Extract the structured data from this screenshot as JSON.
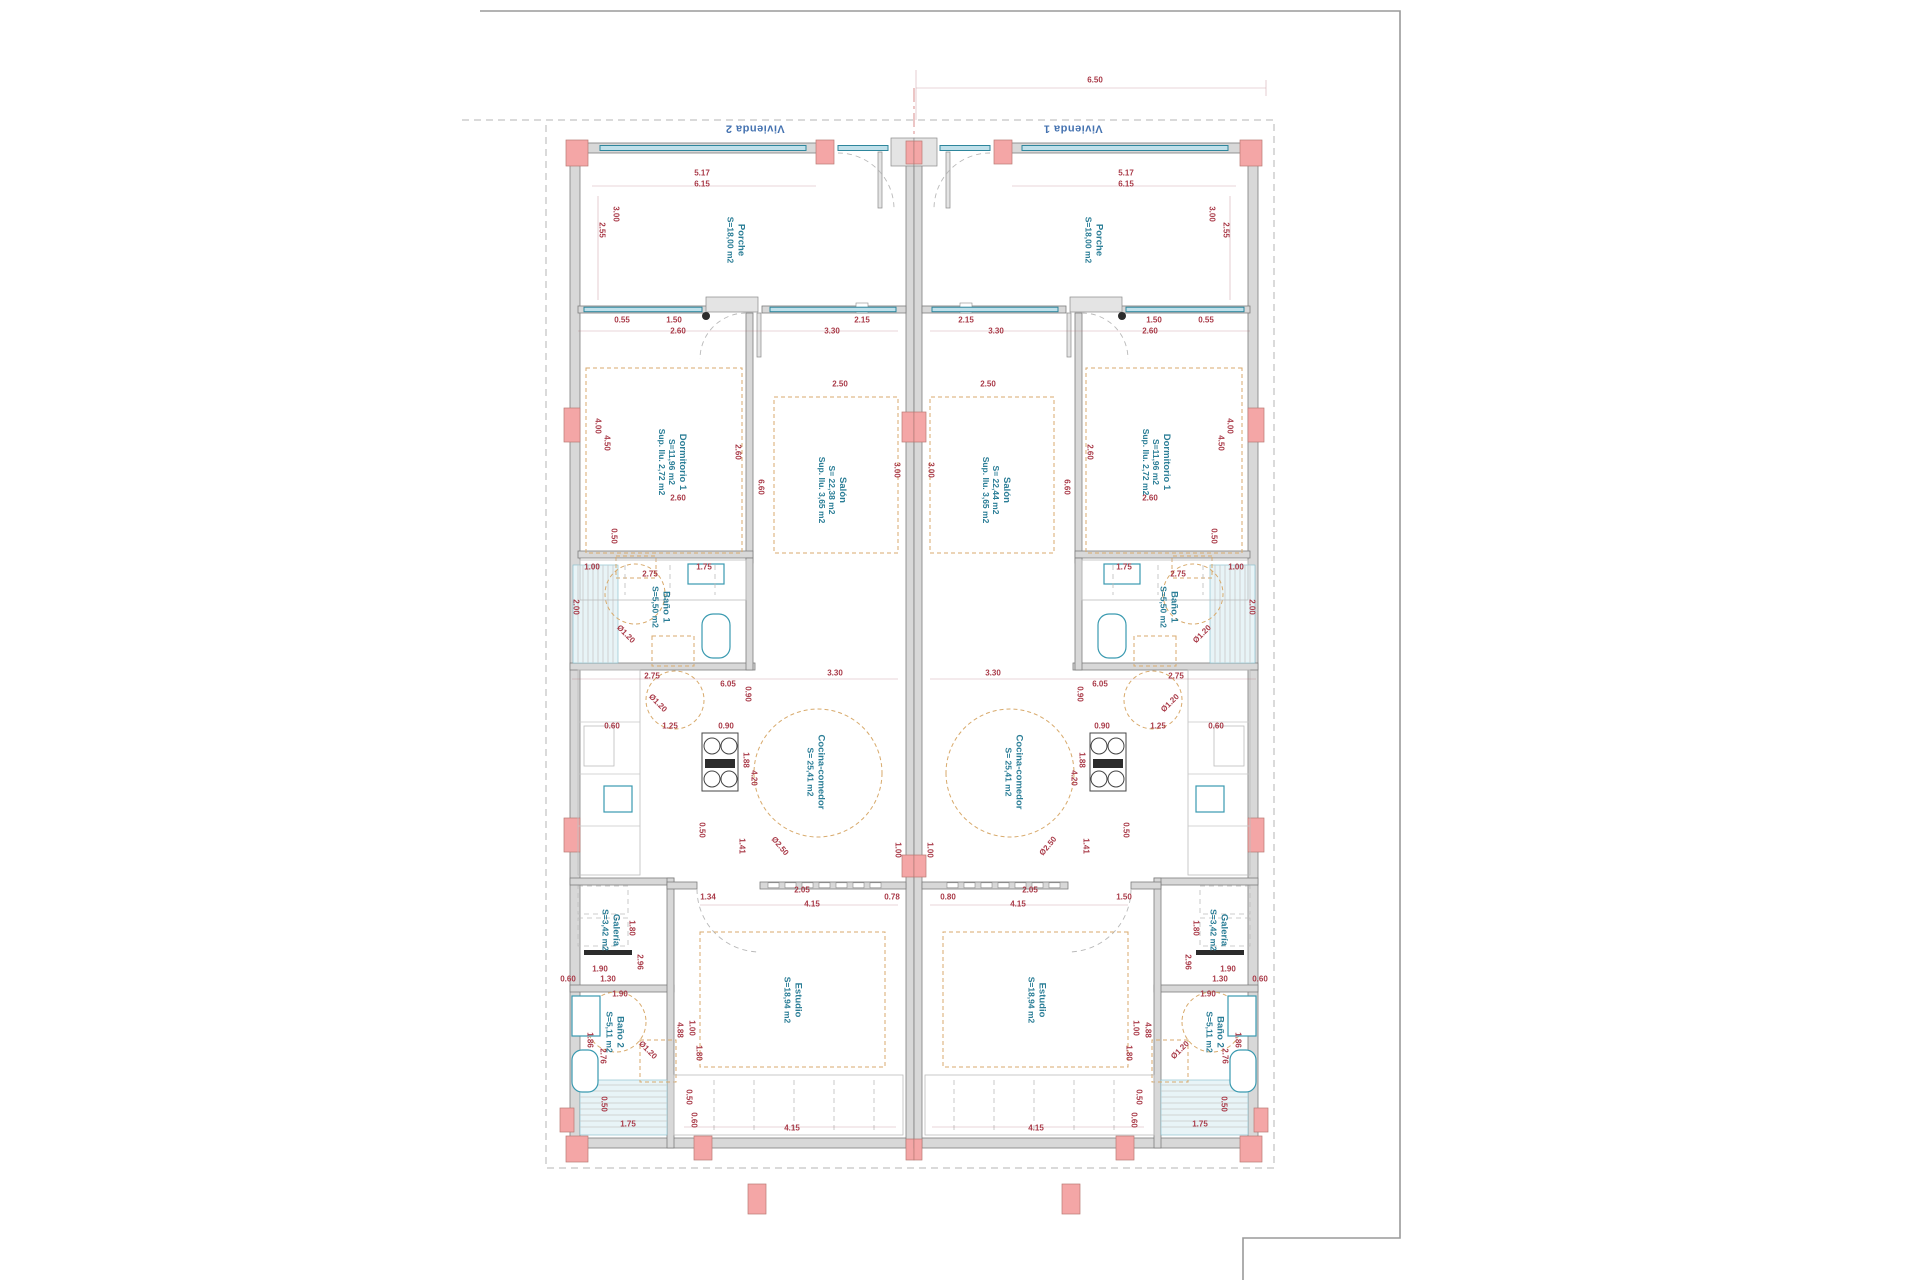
{
  "drawing": {
    "type": "architectural-floor-plan",
    "dwellings": [
      {
        "name": "Vivienda 2",
        "side": "left"
      },
      {
        "name": "Vivienda 1",
        "side": "right"
      }
    ],
    "colors": {
      "wall_fill": "#d8d8d8",
      "column_pink": "#f4a6a6",
      "window_teal": "#2e869c",
      "dimension_red": "#a93a48",
      "room_label_teal": "#2a7d96",
      "vivienda_blue": "#4472b0",
      "furniture_tan": "#d8aa6c"
    },
    "mirror_x": 914,
    "room_labels": [
      {
        "lines": [
          "Vivienda 2"
        ],
        "x": 755,
        "y": 128,
        "r": 180,
        "cls": "viv"
      },
      {
        "lines": [
          "Vivienda 1"
        ],
        "x": 1073,
        "y": 128,
        "r": 180,
        "cls": "viv"
      },
      {
        "lines": [
          "Porche",
          "S=18,00 m2"
        ],
        "x": 735,
        "y": 240,
        "r": 90,
        "cls": "room"
      },
      {
        "lines": [
          "Porche",
          "S=18,00 m2"
        ],
        "x": 1093,
        "y": 240,
        "r": 90,
        "cls": "room"
      },
      {
        "lines": [
          "Dormitorio 1",
          "S=11,96 m2",
          "Sup. Ilu. 2,72 m2"
        ],
        "x": 672,
        "y": 462,
        "r": 90,
        "cls": "room"
      },
      {
        "lines": [
          "Dormitorio 1",
          "S=11,96 m2",
          "Sup. Ilu. 2,72 m2"
        ],
        "x": 1156,
        "y": 462,
        "r": 90,
        "cls": "room"
      },
      {
        "lines": [
          "Salón",
          "S= 22,38 m2",
          "Sup. Ilu. 3,65 m2"
        ],
        "x": 832,
        "y": 490,
        "r": 90,
        "cls": "room"
      },
      {
        "lines": [
          "Salón",
          "S= 22,44 m2",
          "Sup. Ilu. 3,65 m2"
        ],
        "x": 996,
        "y": 490,
        "r": 90,
        "cls": "room"
      },
      {
        "lines": [
          "Baño 1",
          "S=5,50 m2"
        ],
        "x": 660,
        "y": 607,
        "r": 90,
        "cls": "room"
      },
      {
        "lines": [
          "Baño 1",
          "S=5,50 m2"
        ],
        "x": 1168,
        "y": 607,
        "r": 90,
        "cls": "room"
      },
      {
        "lines": [
          "Cocina-comedor",
          "S= 25,41 m2"
        ],
        "x": 815,
        "y": 772,
        "r": 90,
        "cls": "room"
      },
      {
        "lines": [
          "Cocina-comedor",
          "S= 25,41 m2"
        ],
        "x": 1013,
        "y": 772,
        "r": 90,
        "cls": "room"
      },
      {
        "lines": [
          "Galería",
          "S=3,42 m2"
        ],
        "x": 610,
        "y": 930,
        "r": 90,
        "cls": "room"
      },
      {
        "lines": [
          "Galería",
          "S=3,42 m2"
        ],
        "x": 1218,
        "y": 930,
        "r": 90,
        "cls": "room"
      },
      {
        "lines": [
          "Estudio",
          "S=18,94 m2"
        ],
        "x": 792,
        "y": 1000,
        "r": 90,
        "cls": "room"
      },
      {
        "lines": [
          "Estudio",
          "S=18,94 m2"
        ],
        "x": 1036,
        "y": 1000,
        "r": 90,
        "cls": "room"
      },
      {
        "lines": [
          "Baño 2",
          "S=5,11 m2"
        ],
        "x": 614,
        "y": 1032,
        "r": 90,
        "cls": "room"
      },
      {
        "lines": [
          "Baño 2",
          "S=5,11 m2"
        ],
        "x": 1214,
        "y": 1032,
        "r": 90,
        "cls": "room"
      }
    ],
    "dimensions": [
      {
        "t": "6.50",
        "x": 1095,
        "y": 80
      },
      {
        "t": "5.17",
        "x": 702,
        "y": 173,
        "m": 1
      },
      {
        "t": "6.15",
        "x": 702,
        "y": 184,
        "m": 1
      },
      {
        "t": "3.00",
        "x": 616,
        "y": 214,
        "r": 90,
        "m": 1
      },
      {
        "t": "2.55",
        "x": 602,
        "y": 230,
        "r": 90,
        "m": 1
      },
      {
        "t": "0.55",
        "x": 622,
        "y": 320,
        "m": 1
      },
      {
        "t": "1.50",
        "x": 674,
        "y": 320,
        "m": 1
      },
      {
        "t": "2.60",
        "x": 678,
        "y": 331,
        "m": 1
      },
      {
        "t": "2.15",
        "x": 862,
        "y": 320,
        "m": 1
      },
      {
        "t": "3.30",
        "x": 832,
        "y": 331,
        "m": 1
      },
      {
        "t": "4.00",
        "x": 598,
        "y": 426,
        "r": 90,
        "m": 1
      },
      {
        "t": "4.50",
        "x": 607,
        "y": 443,
        "r": 90,
        "m": 1
      },
      {
        "t": "2.60",
        "x": 738,
        "y": 452,
        "r": 90,
        "m": 1
      },
      {
        "t": "2.60",
        "x": 678,
        "y": 498,
        "m": 1
      },
      {
        "t": "0.50",
        "x": 614,
        "y": 536,
        "r": 90,
        "m": 1
      },
      {
        "t": "2.50",
        "x": 840,
        "y": 384,
        "m": 1
      },
      {
        "t": "3.00",
        "x": 897,
        "y": 470,
        "r": 90,
        "m": 1
      },
      {
        "t": "6.60",
        "x": 761,
        "y": 487,
        "r": 90,
        "m": 1
      },
      {
        "t": "1.00",
        "x": 592,
        "y": 567,
        "m": 1
      },
      {
        "t": "2.75",
        "x": 650,
        "y": 574,
        "m": 1
      },
      {
        "t": "1.75",
        "x": 704,
        "y": 567,
        "m": 1
      },
      {
        "t": "2.00",
        "x": 576,
        "y": 607,
        "r": 90,
        "m": 1
      },
      {
        "t": "Ø1.20",
        "x": 626,
        "y": 634,
        "r": 45,
        "m": 1
      },
      {
        "t": "2.75",
        "x": 652,
        "y": 676,
        "m": 1
      },
      {
        "t": "6.05",
        "x": 728,
        "y": 684,
        "m": 1
      },
      {
        "t": "3.30",
        "x": 835,
        "y": 673,
        "m": 1
      },
      {
        "t": "0.90",
        "x": 748,
        "y": 694,
        "r": 90,
        "m": 1
      },
      {
        "t": "Ø1.20",
        "x": 658,
        "y": 703,
        "r": 45,
        "m": 1
      },
      {
        "t": "0.60",
        "x": 612,
        "y": 726,
        "m": 1
      },
      {
        "t": "1.25",
        "x": 670,
        "y": 726,
        "m": 1
      },
      {
        "t": "0.90",
        "x": 726,
        "y": 726,
        "m": 1
      },
      {
        "t": "1.88",
        "x": 746,
        "y": 760,
        "r": 90,
        "m": 1
      },
      {
        "t": "4.20",
        "x": 754,
        "y": 778,
        "r": 90,
        "m": 1
      },
      {
        "t": "0.50",
        "x": 702,
        "y": 830,
        "r": 90,
        "m": 1
      },
      {
        "t": "1.41",
        "x": 742,
        "y": 846,
        "r": 90,
        "m": 1
      },
      {
        "t": "Ø2.50",
        "x": 780,
        "y": 846,
        "r": 50,
        "m": 1
      },
      {
        "t": "1.00",
        "x": 898,
        "y": 850,
        "r": 90,
        "m": 1
      },
      {
        "t": "1.34",
        "x": 708,
        "y": 897
      },
      {
        "t": "2.05",
        "x": 802,
        "y": 890
      },
      {
        "t": "0.78",
        "x": 892,
        "y": 897
      },
      {
        "t": "4.15",
        "x": 812,
        "y": 904
      },
      {
        "t": "0.80",
        "x": 948,
        "y": 897
      },
      {
        "t": "2.05",
        "x": 1030,
        "y": 890
      },
      {
        "t": "1.50",
        "x": 1124,
        "y": 897
      },
      {
        "t": "4.15",
        "x": 1018,
        "y": 904
      },
      {
        "t": "1.90",
        "x": 600,
        "y": 969,
        "m": 1
      },
      {
        "t": "1.30",
        "x": 608,
        "y": 979,
        "m": 1
      },
      {
        "t": "0.60",
        "x": 568,
        "y": 979,
        "m": 1
      },
      {
        "t": "1.80",
        "x": 632,
        "y": 928,
        "r": 90,
        "m": 1
      },
      {
        "t": "2.96",
        "x": 640,
        "y": 962,
        "r": 90,
        "m": 1
      },
      {
        "t": "1.90",
        "x": 620,
        "y": 994,
        "m": 1
      },
      {
        "t": "1.86",
        "x": 590,
        "y": 1040,
        "r": 90,
        "m": 1
      },
      {
        "t": "2.76",
        "x": 603,
        "y": 1056,
        "r": 90,
        "m": 1
      },
      {
        "t": "Ø1.20",
        "x": 648,
        "y": 1050,
        "r": 45,
        "m": 1
      },
      {
        "t": "1.00",
        "x": 692,
        "y": 1028,
        "r": 90,
        "m": 1
      },
      {
        "t": "1.80",
        "x": 699,
        "y": 1053,
        "r": 90,
        "m": 1
      },
      {
        "t": "0.50",
        "x": 604,
        "y": 1104,
        "r": 90,
        "m": 1
      },
      {
        "t": "0.50",
        "x": 689,
        "y": 1097,
        "r": 90,
        "m": 1
      },
      {
        "t": "0.60",
        "x": 694,
        "y": 1120,
        "r": 90,
        "m": 1
      },
      {
        "t": "1.75",
        "x": 628,
        "y": 1124,
        "m": 1
      },
      {
        "t": "4.88",
        "x": 680,
        "y": 1030,
        "r": 90,
        "m": 1
      },
      {
        "t": "4.15",
        "x": 792,
        "y": 1128,
        "m": 1
      }
    ]
  }
}
